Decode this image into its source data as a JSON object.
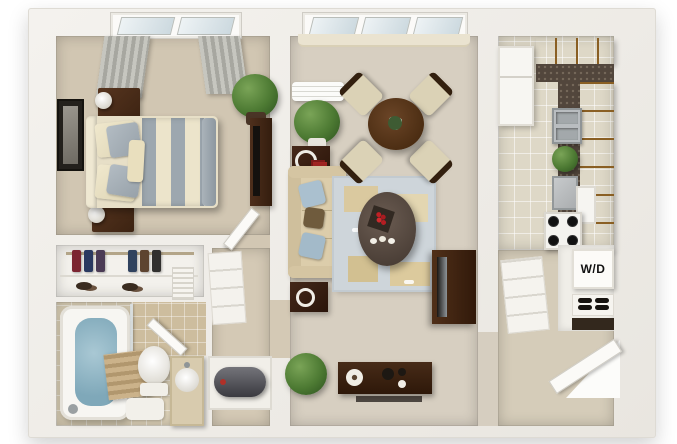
{
  "scene": {
    "type": "3d-apartment-floorplan-rendering",
    "text_labels": {
      "washer_dryer": "W/D"
    },
    "palette": {
      "background": "#ffffff",
      "walls": "#f2f0ec",
      "carpet_bedroom": "#d1c6b2",
      "carpet_living": "#d7cfc1",
      "tile_kitchen": "#ded8c7",
      "tile_bathroom": "#d8cdb4",
      "wood_cabinets": "#c28f45",
      "granite_counter": "#52463c",
      "dark_wood_furniture": "#46291a",
      "bed_stripe_gray": "#9da7af",
      "bed_stripe_cream": "#ece4cb",
      "rug_blue_gray": "#ced5da",
      "rug_tan_accent": "#dac99f",
      "sofa_tan": "#dccdab",
      "pillow_blue": "#aac0cf",
      "plant_green": "#4d7a33",
      "tub_water_blue": "#8fb5c4",
      "stainless_steel": "#b9bdc0",
      "curtain_gray": "#b0b0a9"
    },
    "rooms": {
      "bedroom": {
        "items": [
          "window-with-gray-curtains",
          "framed-wall-art",
          "double-bed-striped-duvet",
          "nightstand-with-lamp-top",
          "nightstand-with-lamp-bottom",
          "potted-plant",
          "dresser-with-tv",
          "door-ajar"
        ]
      },
      "closet": {
        "items": [
          "hanging-clothes",
          "shoes",
          "louver-vent-panel"
        ]
      },
      "bathroom": {
        "items": [
          "bathtub-with-water",
          "shower-glass",
          "wood-bath-mat",
          "toilet",
          "floor-mat",
          "vanity-with-round-sink",
          "door-ajar"
        ]
      },
      "hallway": {
        "items": [
          "linen-shelves",
          "water-heater-closet"
        ]
      },
      "living_room": {
        "items": [
          "window-with-valance",
          "air-conditioner-unit",
          "potted-plant",
          "tray-side-table",
          "sofa-with-pillows",
          "end-table-with-cup",
          "area-rug",
          "oval-coffee-table-with-berry-tray",
          "round-dining-table-with-centerpiece",
          "four-dining-chairs",
          "tv-on-media-stand",
          "floor-bush-plant",
          "sideboard-with-decor"
        ]
      },
      "kitchen": {
        "items": [
          "refrigerator",
          "upper-cabinets",
          "l-shaped-granite-counter",
          "double-basin-sink",
          "counter-plant",
          "dishwasher",
          "stove-four-burners",
          "microwave"
        ]
      },
      "entry": {
        "items": [
          "pantry-shelves",
          "stacked-washer-dryer",
          "shoe-shelf",
          "open-entry-door"
        ]
      }
    }
  }
}
